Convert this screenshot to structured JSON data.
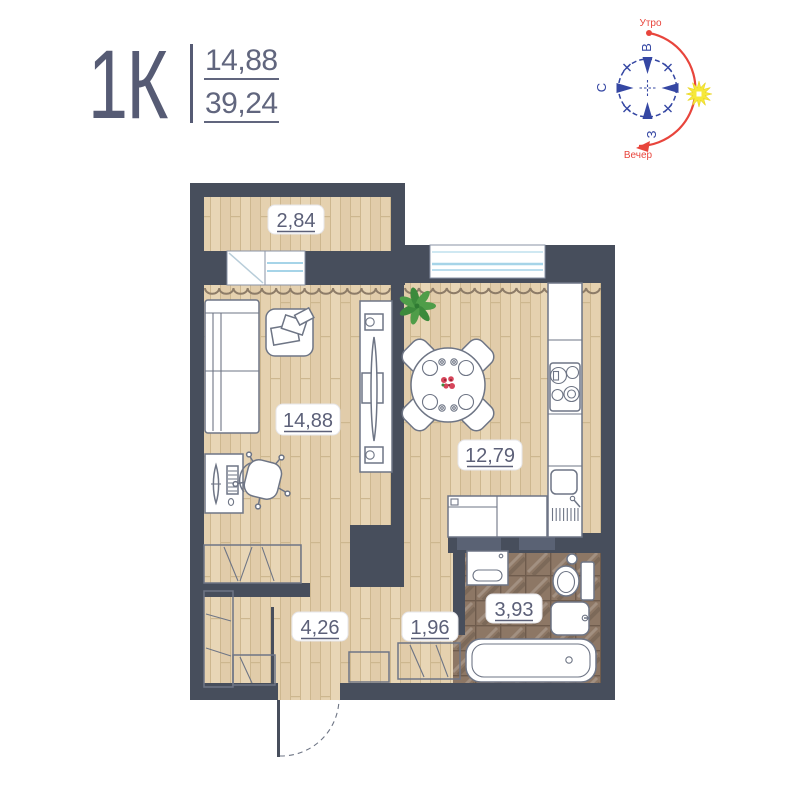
{
  "header": {
    "title": "1К",
    "area_upper": "14,88",
    "area_lower": "39,24"
  },
  "rooms": {
    "balcony": {
      "area": "2,84"
    },
    "living": {
      "area": "14,88"
    },
    "kitchen": {
      "area": "12,79"
    },
    "hallway": {
      "area": "4,26"
    },
    "corridor": {
      "area": "1,96"
    },
    "bathroom": {
      "area": "3,93"
    }
  },
  "compass": {
    "east": "В",
    "north": "С",
    "west": "З",
    "morning": "Утро",
    "evening": "Вечер"
  },
  "colors": {
    "accent": "#565b74",
    "num": "#61667e",
    "wall": "#474e5c",
    "vent": "#5a6274",
    "line": "#6e7585",
    "label-text": "#5c6078",
    "wood-a": "#e8d6b6",
    "wood-b": "#e1ccaa",
    "wood-c": "#e5d1af",
    "wood-line": "#cdb78f",
    "tile-a": "#8d7765",
    "tile-line": "#6f5c4d",
    "window-blue": "#a6d4e8",
    "window-blue-light": "#cfe8f2",
    "curtain": "#8d7c68",
    "blue": "#3547a3",
    "red": "#e8453c",
    "sun": "#f6e83b",
    "plant-a": "#4f9d49",
    "plant-b": "#3c8a3c",
    "flower": "#d6455a"
  }
}
